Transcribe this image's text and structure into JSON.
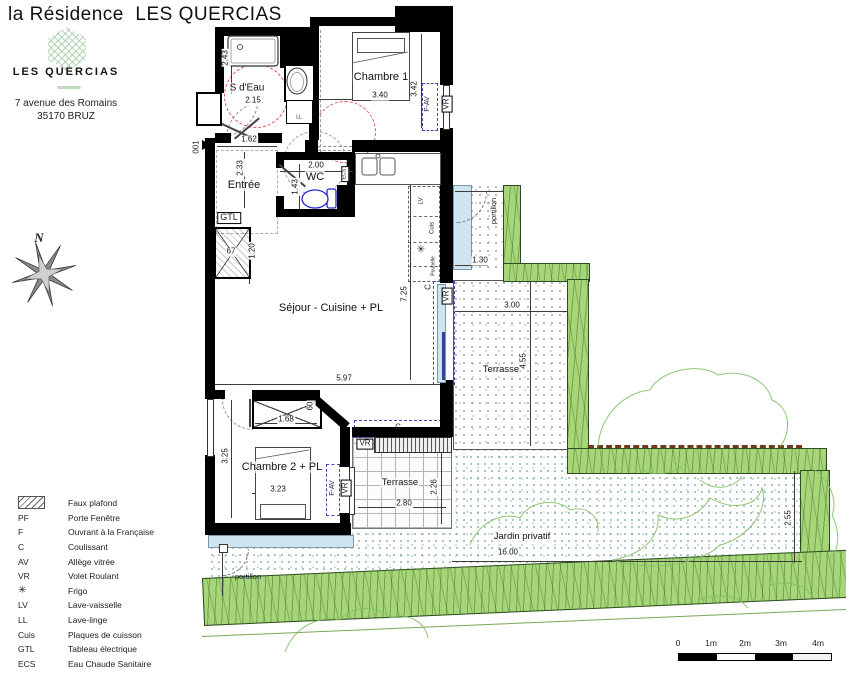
{
  "header": {
    "title": "la Résidence  LES QUERCIAS",
    "logo_name": "LES QUERCIAS",
    "address_line1": "7 avenue des Romains",
    "address_line2": "35170 BRUZ"
  },
  "compass": {
    "north_label": "N"
  },
  "plan": {
    "rooms": [
      {
        "name": "S d'Eau",
        "x": 247,
        "y": 88,
        "fs": 10
      },
      {
        "name": "Chambre 1",
        "x": 381,
        "y": 77,
        "fs": 11
      },
      {
        "name": "Entrée",
        "x": 244,
        "y": 185,
        "fs": 11
      },
      {
        "name": "WC",
        "x": 315,
        "y": 177,
        "fs": 11
      },
      {
        "name": "Séjour - Cuisine + PL",
        "x": 331,
        "y": 308,
        "fs": 11
      },
      {
        "name": "Chambre 2 + PL",
        "x": 282,
        "y": 467,
        "fs": 11
      },
      {
        "name": "Terrasse",
        "x": 400,
        "y": 483,
        "fs": 9.5
      },
      {
        "name": "Terrasse",
        "x": 501,
        "y": 370,
        "fs": 9.5
      },
      {
        "name": "Jardin privatif",
        "x": 522,
        "y": 537,
        "fs": 9.5
      }
    ],
    "dimensions": [
      {
        "t": "2.43",
        "x": 226,
        "y": 58,
        "r": -90
      },
      {
        "t": "2.15",
        "x": 253,
        "y": 101,
        "r": 0
      },
      {
        "t": "1.62",
        "x": 249,
        "y": 140,
        "r": 0
      },
      {
        "t": "2.33",
        "x": 241,
        "y": 168,
        "r": -90
      },
      {
        "t": "2.00",
        "x": 316,
        "y": 166,
        "r": 0
      },
      {
        "t": "1.43",
        "x": 296,
        "y": 187,
        "r": -90
      },
      {
        "t": "3.40",
        "x": 380,
        "y": 96,
        "r": 0
      },
      {
        "t": "3.42",
        "x": 415,
        "y": 89,
        "r": -90
      },
      {
        "t": "1.20",
        "x": 253,
        "y": 251,
        "r": -90
      },
      {
        "t": "5.97",
        "x": 344,
        "y": 379,
        "r": 0
      },
      {
        "t": "7.25",
        "x": 405,
        "y": 294,
        "r": -90
      },
      {
        "t": "1.68",
        "x": 286,
        "y": 420,
        "r": 0
      },
      {
        "t": "60",
        "x": 311,
        "y": 406,
        "r": -90
      },
      {
        "t": "3.25",
        "x": 226,
        "y": 456,
        "r": -90
      },
      {
        "t": "3.23",
        "x": 278,
        "y": 490,
        "r": 0
      },
      {
        "t": "2.80",
        "x": 404,
        "y": 504,
        "r": 0
      },
      {
        "t": "2.26",
        "x": 435,
        "y": 487,
        "r": -90
      },
      {
        "t": "1.30",
        "x": 480,
        "y": 261,
        "r": 0
      },
      {
        "t": "3.00",
        "x": 512,
        "y": 306,
        "r": 0
      },
      {
        "t": "4.55",
        "x": 524,
        "y": 361,
        "r": -90
      },
      {
        "t": "16.00",
        "x": 508,
        "y": 553,
        "r": 0
      },
      {
        "t": "2.55",
        "x": 789,
        "y": 518,
        "r": -90
      }
    ],
    "annotations": [
      {
        "t": "001",
        "x": 197,
        "y": 147,
        "r": -90,
        "fs": 8
      },
      {
        "t": "GTL",
        "x": 229,
        "y": 218,
        "r": 0,
        "fs": 9,
        "box": true
      },
      {
        "t": "67",
        "x": 231,
        "y": 252,
        "r": 0,
        "fs": 8,
        "halo": true
      },
      {
        "t": "ECS",
        "x": 345,
        "y": 174,
        "r": -90,
        "fs": 5,
        "box": true
      },
      {
        "t": "LL",
        "x": 299,
        "y": 118,
        "r": 0,
        "fs": 5
      },
      {
        "t": "LV",
        "x": 422,
        "y": 201,
        "r": -90,
        "fs": 6
      },
      {
        "t": "Cuis",
        "x": 433,
        "y": 228,
        "r": -90,
        "fs": 6
      },
      {
        "t": "✳",
        "x": 421,
        "y": 250,
        "r": 0,
        "fs": 10,
        "icon": "frigo-icon"
      },
      {
        "t": "Poubelle",
        "x": 434,
        "y": 266,
        "r": -90,
        "fs": 5
      },
      {
        "t": "F-AV",
        "x": 428,
        "y": 104,
        "r": -90,
        "fs": 7
      },
      {
        "t": "VR",
        "x": 447,
        "y": 104,
        "r": -90,
        "fs": 8,
        "box": true
      },
      {
        "t": "C",
        "x": 429,
        "y": 287,
        "r": -90,
        "fs": 8
      },
      {
        "t": "VR",
        "x": 447,
        "y": 296,
        "r": -90,
        "fs": 8,
        "box": true
      },
      {
        "t": "F-AV",
        "x": 333,
        "y": 488,
        "r": -90,
        "fs": 7
      },
      {
        "t": "VR",
        "x": 346,
        "y": 488,
        "r": -90,
        "fs": 8,
        "box": true
      },
      {
        "t": "C",
        "x": 398,
        "y": 428,
        "r": 0,
        "fs": 8
      },
      {
        "t": "VR",
        "x": 365,
        "y": 444,
        "r": 0,
        "fs": 8,
        "box": true
      },
      {
        "t": "portillon",
        "x": 494,
        "y": 211,
        "r": -90,
        "fs": 7.5
      },
      {
        "t": "portillon",
        "x": 248,
        "y": 577,
        "r": 0,
        "fs": 7.5
      }
    ]
  },
  "legend": {
    "items": [
      {
        "sym": "hatch",
        "label": "Faux plafond"
      },
      {
        "sym": "PF",
        "label": "Porte Fenêtre"
      },
      {
        "sym": "F",
        "label": "Ouvrant à la Française"
      },
      {
        "sym": "C",
        "label": "Coulissant"
      },
      {
        "sym": "AV",
        "label": "Allège vitrée"
      },
      {
        "sym": "VR",
        "label": "Volet Roulant"
      },
      {
        "sym": "star",
        "label": "Frigo"
      },
      {
        "sym": "LV",
        "label": "Lave-vaisselle"
      },
      {
        "sym": "LL",
        "label": "Lave-linge"
      },
      {
        "sym": "Cuis",
        "label": "Plaques de cuisson"
      },
      {
        "sym": "GTL",
        "label": "Tableau électrique"
      },
      {
        "sym": "ECS",
        "label": "Eau Chaude Sanitaire"
      }
    ]
  },
  "scalebar": {
    "labels": [
      "0",
      "1m",
      "2m",
      "3m",
      "4m"
    ]
  },
  "colors": {
    "hedge": "#a6d678",
    "glass": "#cfe4f1",
    "toilet": "#2626cc",
    "red_circle": "#dd5555",
    "logo_green": "#9cc79b",
    "dash_blue": "#4646b4",
    "brown_wall": "#6e3a17"
  }
}
